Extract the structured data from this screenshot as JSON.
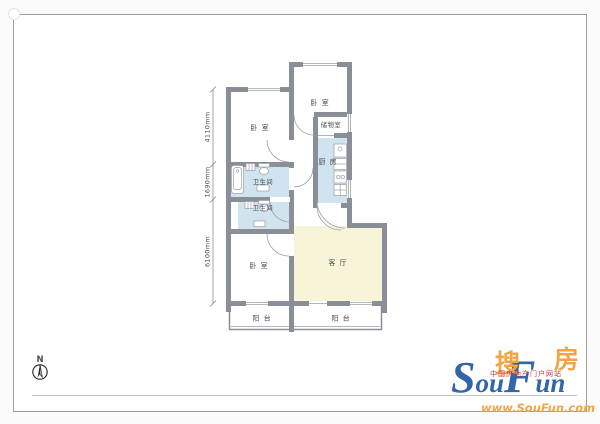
{
  "floorplan": {
    "rooms": {
      "bedroom_top_left": "卧 室",
      "bedroom_top_right": "卧 室",
      "storage_room": "储物室",
      "kitchen": "厨 房",
      "bathroom_upper": "卫生间",
      "bathroom_lower": "卫生间",
      "bedroom_lower": "卧 室",
      "living_room": "客 厅",
      "balcony_left": "阳 台",
      "balcony_right": "阳 台"
    },
    "dimensions": {
      "upper": "4110mm",
      "middle": "1690mm",
      "lower": "6100mm"
    },
    "compass": {
      "label": "N"
    },
    "colors": {
      "wall": "#8a8e97",
      "wet_area_fill": "#cfe4ef",
      "living_fill": "#f8f4d7",
      "thin_line": "#9aa0a8"
    }
  },
  "branding": {
    "logo_cn_left": "搜",
    "logo_cn_right": "房",
    "logo_en_s": "S",
    "logo_en_ou": "ou",
    "logo_en_f": "F",
    "logo_en_un": "un",
    "tagline": "中国房地产门户网站",
    "website": "www.SouFun.com",
    "colors": {
      "orange": "#f2a544",
      "blue": "#3465ab",
      "red": "#c43a36"
    }
  }
}
